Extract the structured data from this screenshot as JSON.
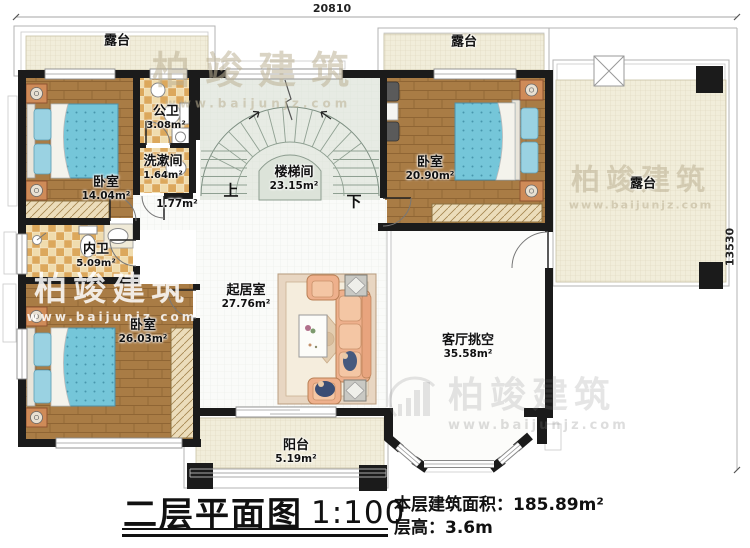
{
  "plan": {
    "name": "二层平面图",
    "scale": "1:100",
    "info": [
      {
        "label": "本层建筑面积：",
        "value": "185.89m²"
      },
      {
        "label": "层高：",
        "value": "3.6m"
      }
    ],
    "dim_top": "20810",
    "dim_right": "13530"
  },
  "rooms": {
    "terrace_tl": {
      "name": "露台"
    },
    "terrace_tr": {
      "name": "露台"
    },
    "terrace_r": {
      "name": "露台"
    },
    "bedroom1": {
      "name": "卧室",
      "area": "14.04m²"
    },
    "public_bath": {
      "name": "公卫",
      "area": "3.08m²"
    },
    "washroom": {
      "name": "洗漱间",
      "area": "1.64m²"
    },
    "hallway": {
      "area": "1.77m²"
    },
    "stairwell": {
      "name": "楼梯间",
      "area": "23.15m²",
      "up": "上",
      "down": "下"
    },
    "bedroom2": {
      "name": "卧室",
      "area": "20.90m²"
    },
    "inner_bath": {
      "name": "内卫",
      "area": "5.09m²"
    },
    "bedroom3": {
      "name": "卧室",
      "area": "26.03m²"
    },
    "living_room": {
      "name": "起居室",
      "area": "27.76m²"
    },
    "void": {
      "name": "客厅挑空",
      "area": "35.58m²"
    },
    "balcony": {
      "name": "阳台",
      "area": "5.19m²"
    }
  },
  "watermark": {
    "brand": "柏竣建筑",
    "url": "www.baijunjz.com"
  },
  "colors": {
    "wall": "#1b1b1b",
    "wood": "#a97c45",
    "tile": "#dca85c",
    "bed": "#75c6d9",
    "terrace": "#f1edda",
    "sofa": "#eeb08c"
  }
}
